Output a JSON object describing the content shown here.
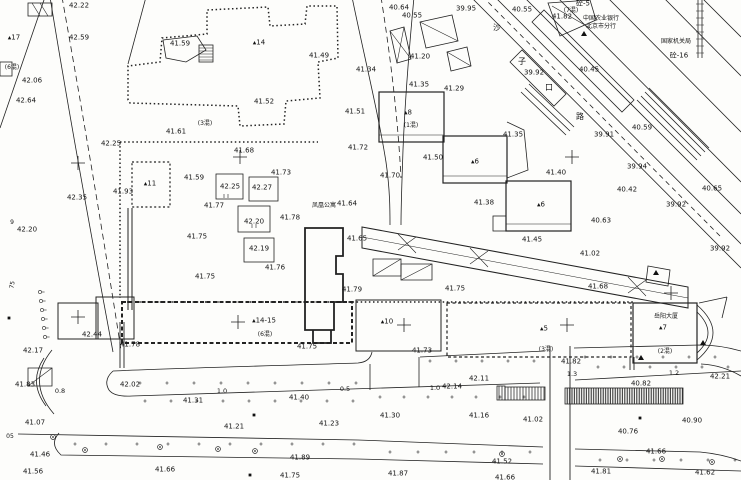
{
  "colors": {
    "ink": "#1c1c1c",
    "paper": "#fdfdfb"
  },
  "labels": {
    "elevations": [
      {
        "t": "42.22",
        "x": 79,
        "y": 6
      },
      {
        "t": "42.59",
        "x": 79,
        "y": 38
      },
      {
        "t": "41.59",
        "x": 180,
        "y": 44
      },
      {
        "t": "42.06",
        "x": 32,
        "y": 81
      },
      {
        "t": "42.64",
        "x": 26,
        "y": 101
      },
      {
        "t": "42.25",
        "x": 111,
        "y": 144
      },
      {
        "t": "41.61",
        "x": 176,
        "y": 132
      },
      {
        "t": "41.68",
        "x": 244,
        "y": 151
      },
      {
        "t": "40.64",
        "x": 399,
        "y": 8
      },
      {
        "t": "40.55",
        "x": 412,
        "y": 16
      },
      {
        "t": "39.95",
        "x": 466,
        "y": 9
      },
      {
        "t": "41.49",
        "x": 319,
        "y": 56
      },
      {
        "t": "41.20",
        "x": 420,
        "y": 57
      },
      {
        "t": "41.34",
        "x": 366,
        "y": 70
      },
      {
        "t": "41.35",
        "x": 419,
        "y": 85
      },
      {
        "t": "41.29",
        "x": 454,
        "y": 89
      },
      {
        "t": "41.52",
        "x": 264,
        "y": 102
      },
      {
        "t": "41.51",
        "x": 355,
        "y": 112
      },
      {
        "t": "41.72",
        "x": 358,
        "y": 148
      },
      {
        "t": "41.50",
        "x": 433,
        "y": 158
      },
      {
        "t": "40.55",
        "x": 522,
        "y": 10
      },
      {
        "t": "41.82",
        "x": 562,
        "y": 17
      },
      {
        "t": "39.92",
        "x": 534,
        "y": 73
      },
      {
        "t": "40.45",
        "x": 589,
        "y": 70
      },
      {
        "t": "40.59",
        "x": 642,
        "y": 128
      },
      {
        "t": "39.91",
        "x": 604,
        "y": 135
      },
      {
        "t": "41.35",
        "x": 513,
        "y": 135
      },
      {
        "t": "42.35",
        "x": 77,
        "y": 198
      },
      {
        "t": "41.93",
        "x": 123,
        "y": 192
      },
      {
        "t": "41.59",
        "x": 194,
        "y": 178
      },
      {
        "t": "42.25",
        "x": 230,
        "y": 187
      },
      {
        "t": "42.27",
        "x": 262,
        "y": 188
      },
      {
        "t": "41.77",
        "x": 214,
        "y": 206
      },
      {
        "t": "41.75",
        "x": 197,
        "y": 237
      },
      {
        "t": "41.75",
        "x": 205,
        "y": 277
      },
      {
        "t": "42.20",
        "x": 27,
        "y": 230
      },
      {
        "t": "41.73",
        "x": 281,
        "y": 173
      },
      {
        "t": "41.70",
        "x": 390,
        "y": 176
      },
      {
        "t": "41.64",
        "x": 347,
        "y": 204
      },
      {
        "t": "42.20",
        "x": 254,
        "y": 222
      },
      {
        "t": "41.78",
        "x": 290,
        "y": 218
      },
      {
        "t": "41.65",
        "x": 357,
        "y": 239
      },
      {
        "t": "42.19",
        "x": 259,
        "y": 249
      },
      {
        "t": "41.76",
        "x": 275,
        "y": 268
      },
      {
        "t": "41.79",
        "x": 352,
        "y": 290
      },
      {
        "t": "41.75",
        "x": 455,
        "y": 289
      },
      {
        "t": "41.38",
        "x": 484,
        "y": 203
      },
      {
        "t": "41.40",
        "x": 556,
        "y": 173
      },
      {
        "t": "39.94",
        "x": 637,
        "y": 167
      },
      {
        "t": "40.42",
        "x": 627,
        "y": 190
      },
      {
        "t": "40.65",
        "x": 712,
        "y": 189
      },
      {
        "t": "39.92",
        "x": 676,
        "y": 205
      },
      {
        "t": "40.63",
        "x": 601,
        "y": 221
      },
      {
        "t": "41.45",
        "x": 532,
        "y": 240
      },
      {
        "t": "39.92",
        "x": 720,
        "y": 249
      },
      {
        "t": "41.02",
        "x": 590,
        "y": 254
      },
      {
        "t": "41.68",
        "x": 598,
        "y": 287
      },
      {
        "t": "42.44",
        "x": 92,
        "y": 335
      },
      {
        "t": "42.17",
        "x": 33,
        "y": 351
      },
      {
        "t": "41.78",
        "x": 130,
        "y": 345
      },
      {
        "t": "41.83",
        "x": 25,
        "y": 385
      },
      {
        "t": "42.02",
        "x": 130,
        "y": 385
      },
      {
        "t": "41.31",
        "x": 193,
        "y": 401
      },
      {
        "t": "41.07",
        "x": 35,
        "y": 423
      },
      {
        "t": "41.21",
        "x": 234,
        "y": 427
      },
      {
        "t": "41.46",
        "x": 40,
        "y": 455
      },
      {
        "t": "41.56",
        "x": 33,
        "y": 472
      },
      {
        "t": "41.66",
        "x": 165,
        "y": 470
      },
      {
        "t": "41.89",
        "x": 300,
        "y": 458
      },
      {
        "t": "41.75",
        "x": 290,
        "y": 476
      },
      {
        "t": "41.75",
        "x": 307,
        "y": 347
      },
      {
        "t": "41.73",
        "x": 422,
        "y": 351
      },
      {
        "t": "42.11",
        "x": 479,
        "y": 379
      },
      {
        "t": "42.14",
        "x": 452,
        "y": 387
      },
      {
        "t": "41.40",
        "x": 299,
        "y": 398
      },
      {
        "t": "41.30",
        "x": 390,
        "y": 416
      },
      {
        "t": "41.16",
        "x": 479,
        "y": 416
      },
      {
        "t": "41.23",
        "x": 329,
        "y": 424
      },
      {
        "t": "41.87",
        "x": 398,
        "y": 474
      },
      {
        "t": "41.52",
        "x": 502,
        "y": 462
      },
      {
        "t": "41.66",
        "x": 505,
        "y": 478
      },
      {
        "t": "41.82",
        "x": 571,
        "y": 362
      },
      {
        "t": "40.82",
        "x": 641,
        "y": 384
      },
      {
        "t": "42.21",
        "x": 720,
        "y": 377
      },
      {
        "t": "41.02",
        "x": 533,
        "y": 420
      },
      {
        "t": "40.90",
        "x": 692,
        "y": 421
      },
      {
        "t": "40.76",
        "x": 628,
        "y": 432
      },
      {
        "t": "41.66",
        "x": 656,
        "y": 452
      },
      {
        "t": "41.81",
        "x": 601,
        "y": 472
      },
      {
        "t": "41.62",
        "x": 705,
        "y": 473
      }
    ],
    "distances": [
      {
        "t": "0.8",
        "x": 60,
        "y": 391
      },
      {
        "t": "1.0",
        "x": 222,
        "y": 391
      },
      {
        "t": "0.5",
        "x": 345,
        "y": 389
      },
      {
        "t": "1.0",
        "x": 435,
        "y": 388
      },
      {
        "t": "1.3",
        "x": 572,
        "y": 374
      },
      {
        "t": "1.2",
        "x": 674,
        "y": 373
      }
    ],
    "buildings": [
      {
        "t": "▴17",
        "x": 14,
        "y": 38
      },
      {
        "t": "▴14",
        "x": 259,
        "y": 43
      },
      {
        "t": "▴11",
        "x": 150,
        "y": 184
      },
      {
        "t": "▴14-15",
        "x": 264,
        "y": 321
      },
      {
        "t": "▴10",
        "x": 387,
        "y": 322
      },
      {
        "t": "▴5",
        "x": 544,
        "y": 329
      },
      {
        "t": "▴6",
        "x": 475,
        "y": 162
      },
      {
        "t": "▴6",
        "x": 541,
        "y": 205
      },
      {
        "t": "▴8",
        "x": 408,
        "y": 113
      },
      {
        "t": "▴7",
        "x": 663,
        "y": 328
      },
      {
        "t": "砼-5",
        "x": 583,
        "y": 4
      },
      {
        "t": "砼-16",
        "x": 679,
        "y": 56
      }
    ],
    "construction_notes": [
      {
        "t": "(6混)",
        "x": 12,
        "y": 68
      },
      {
        "t": "(3混)",
        "x": 205,
        "y": 124
      },
      {
        "t": "(6混)",
        "x": 265,
        "y": 335
      },
      {
        "t": "(3混)",
        "x": 546,
        "y": 350
      },
      {
        "t": "(2混)",
        "x": 665,
        "y": 352
      },
      {
        "t": "(7混)",
        "x": 571,
        "y": 11
      },
      {
        "t": "(1混)",
        "x": 411,
        "y": 126
      }
    ],
    "places": [
      {
        "t": "中国农业银行",
        "x": 601,
        "y": 19
      },
      {
        "t": "北京市分行",
        "x": 601,
        "y": 27
      },
      {
        "t": "国家机关局",
        "x": 676,
        "y": 42
      },
      {
        "t": "凤凰公寓",
        "x": 324,
        "y": 206
      },
      {
        "t": "岳阳大厦",
        "x": 666,
        "y": 317
      }
    ],
    "street_chars": [
      {
        "t": "沙",
        "x": 497,
        "y": 28
      },
      {
        "t": "子",
        "x": 522,
        "y": 62
      },
      {
        "t": "口",
        "x": 549,
        "y": 88
      },
      {
        "t": "路",
        "x": 580,
        "y": 117
      }
    ],
    "misc": [
      {
        "t": "9",
        "x": 12,
        "y": 223
      },
      {
        "t": "75",
        "x": 13,
        "y": 285,
        "rot": true
      },
      {
        "t": "05",
        "x": 10,
        "y": 437
      }
    ]
  },
  "symbols": {
    "crosses": [
      [
        78,
        163
      ],
      [
        240,
        157
      ],
      [
        572,
        157
      ],
      [
        78,
        317
      ],
      [
        238,
        322
      ],
      [
        404,
        325
      ],
      [
        567,
        325
      ],
      [
        671,
        293
      ]
    ],
    "trees": [
      [
        53,
        437
      ],
      [
        85,
        450
      ],
      [
        160,
        447
      ],
      [
        218,
        449
      ],
      [
        255,
        451
      ],
      [
        502,
        454
      ],
      [
        620,
        459
      ],
      [
        662,
        459
      ],
      [
        712,
        462
      ]
    ],
    "black_squares": [
      [
        9,
        318
      ],
      [
        254,
        415
      ],
      [
        640,
        418
      ],
      [
        250,
        475
      ]
    ],
    "triangle_marks": [
      [
        641,
        358
      ],
      [
        703,
        343
      ],
      [
        656,
        273
      ],
      [
        584,
        34
      ]
    ],
    "chain_circles": [
      [
        40,
        292
      ],
      [
        41,
        301
      ],
      [
        42,
        310
      ],
      [
        43,
        319
      ],
      [
        44,
        328
      ],
      [
        45,
        337
      ]
    ],
    "plus_rows": [
      {
        "y": 383,
        "x0": 140,
        "x1": 360,
        "step": 27
      },
      {
        "y": 361,
        "x0": 430,
        "x1": 535,
        "step": 26
      },
      {
        "y": 357,
        "x0": 585,
        "x1": 738,
        "step": 26
      },
      {
        "y": 367,
        "x0": 598,
        "x1": 735,
        "step": 26
      },
      {
        "y": 401,
        "x0": 145,
        "x1": 360,
        "step": 26
      },
      {
        "y": 397,
        "x0": 380,
        "x1": 528,
        "step": 24
      },
      {
        "y": 444,
        "x0": 75,
        "x1": 355,
        "step": 31
      },
      {
        "y": 452,
        "x0": 390,
        "x1": 540,
        "step": 28
      },
      {
        "y": 460,
        "x0": 600,
        "x1": 735,
        "step": 27
      }
    ]
  }
}
